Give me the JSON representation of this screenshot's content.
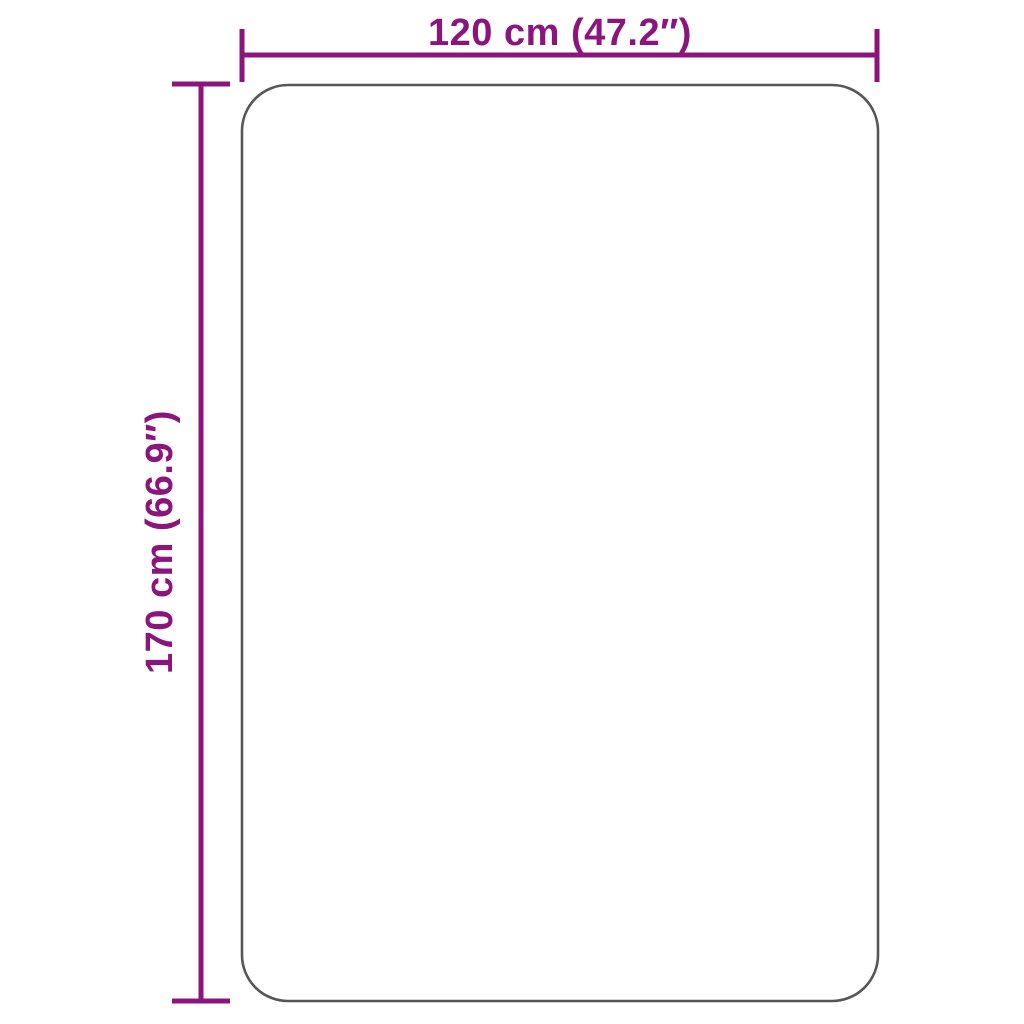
{
  "diagram": {
    "type": "product-dimension-diagram",
    "labels": {
      "width": "120 cm (47.2″)",
      "height": "170 cm (66.9″)"
    },
    "dimensions": {
      "width_cm": 120,
      "width_inches": 47.2,
      "height_cm": 170,
      "height_inches": 66.9
    }
  },
  "colors": {
    "accent": "#8C147D",
    "outline": "#565656",
    "background": "#FFFFFF"
  }
}
